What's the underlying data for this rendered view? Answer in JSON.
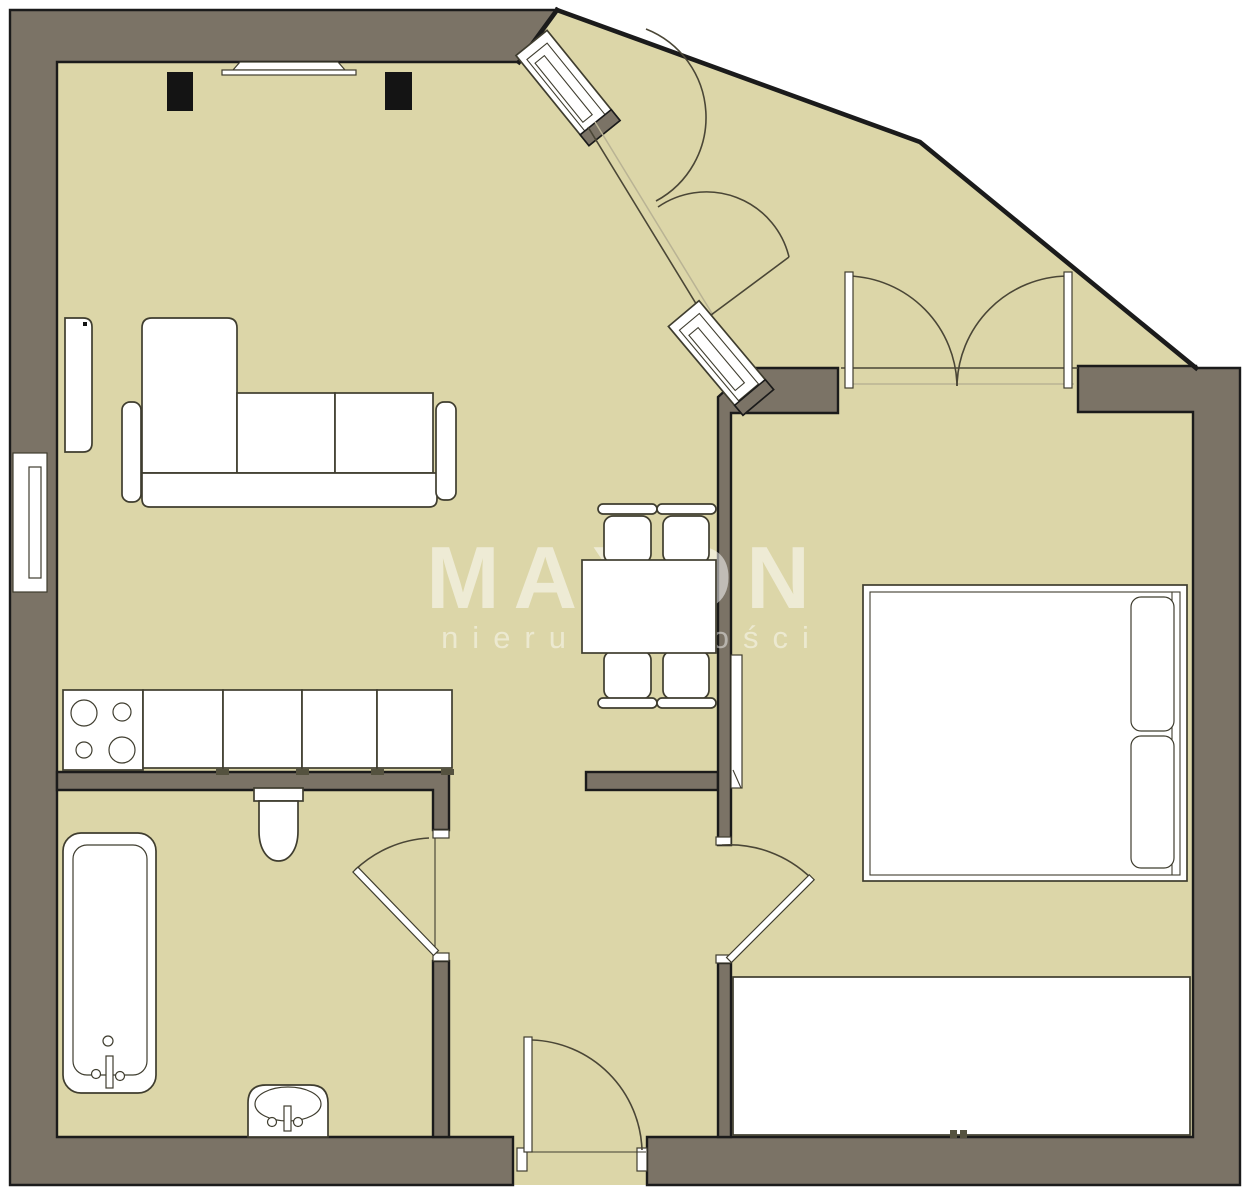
{
  "watermark": {
    "brand": "MAXON",
    "tagline": "nieruchomości"
  },
  "colors": {
    "floor": "#dcd6a8",
    "wall": "#7b7366",
    "outline": "#1b1b1b",
    "stroke": "#3f3d2f",
    "light_stroke": "#b9b394",
    "furniture_fill": "#ffffff",
    "speaker_fill": "#141414",
    "watermark_fill": "rgba(255,255,255,0.52)",
    "watermark_tagline_fill": "rgba(255,255,255,0.46)",
    "page_bg": "#ffffff"
  },
  "legend": {
    "drawing_type": "apartment floor plan",
    "areas": [
      "living-room-with-kitchenette",
      "hallway",
      "bathroom",
      "bedroom",
      "glazed-corner-hall"
    ],
    "elements": [
      "sofa-with-chaise",
      "tv-on-wall",
      "speakers",
      "wall-cabinet",
      "window",
      "kitchen-counter",
      "cooktop-4-burners",
      "dining-table",
      "chairs-x4",
      "bathtub",
      "toilet",
      "wash-basin",
      "bathroom-door",
      "entrance-door",
      "bedroom-door",
      "double-swing-door",
      "glazed-door-panels",
      "bed-double",
      "pillows",
      "wardrobe",
      "radiator"
    ]
  }
}
